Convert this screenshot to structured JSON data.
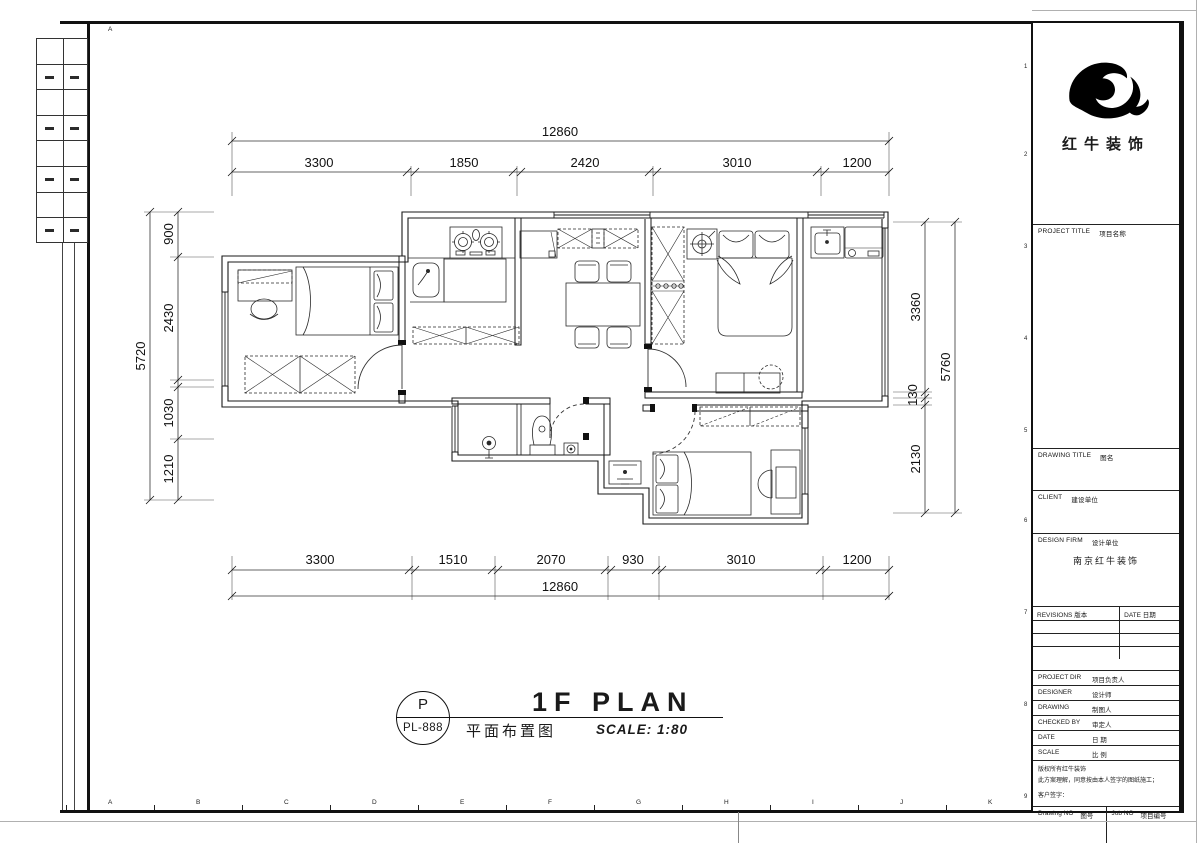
{
  "sheet": {
    "frame": {
      "top_letter": "A",
      "bottom_letters": [
        "A",
        "B",
        "C",
        "D",
        "E",
        "F",
        "G",
        "H",
        "I",
        "J",
        "K"
      ],
      "row_numbers": [
        "1",
        "2",
        "3",
        "4",
        "5",
        "6",
        "7",
        "8",
        "9"
      ]
    }
  },
  "plan_title": {
    "code_letter": "P",
    "code": "PL-888",
    "title_en": "1F PLAN",
    "title_cn": "平面布置图",
    "scale": "SCALE: 1:80"
  },
  "dimensions": {
    "top": {
      "overall": "12860",
      "segments": [
        "3300",
        "1850",
        "2420",
        "3010",
        "1200"
      ]
    },
    "bottom": {
      "overall": "12860",
      "segments": [
        "3300",
        "1510",
        "2070",
        "930",
        "3010",
        "1200"
      ]
    },
    "left": {
      "overall": "5720",
      "segments": [
        "900",
        "2430",
        "1030",
        "1210"
      ]
    },
    "right": {
      "overall": "5760",
      "segments": [
        "3360",
        "130",
        "2130"
      ]
    }
  },
  "title_block": {
    "company_name": "红牛装饰",
    "project_title": {
      "en": "PROJECT TITLE",
      "cn": "项目名称"
    },
    "drawing_title": {
      "en": "DRAWING TITLE",
      "cn": "图名"
    },
    "client": {
      "en": "CLIENT",
      "cn": "建设单位"
    },
    "design_firm": {
      "en": "DESIGN FIRM",
      "cn": "设计单位",
      "value": "南京红牛装饰"
    },
    "revisions": {
      "en": "REVISIONS",
      "cn": "版本"
    },
    "date_col": {
      "en": "DATE",
      "cn": "日期"
    },
    "project_dir": {
      "en": "PROJECT DIR",
      "cn": "项目负责人"
    },
    "designer": {
      "en": "DESIGNER",
      "cn": "设计师"
    },
    "drawing": {
      "en": "DRAWING",
      "cn": "制图人"
    },
    "checked_by": {
      "en": "CHECKED BY",
      "cn": "审定人"
    },
    "date": {
      "en": "DATE",
      "cn": "日 期"
    },
    "scale": {
      "en": "SCALE",
      "cn": "比 例"
    },
    "note_line1": "版权所有红牛装饰",
    "note_line2": "此方案理解，同意按由本人签字的图纸施工；",
    "note_line3": "客户签字：",
    "drawing_no": {
      "en": "Drawing NO",
      "cn": "图号"
    },
    "job_no": {
      "en": "Job NO",
      "cn": "项目编号"
    }
  },
  "colors": {
    "ink": "#1a1a1a",
    "paper": "#ffffff"
  }
}
